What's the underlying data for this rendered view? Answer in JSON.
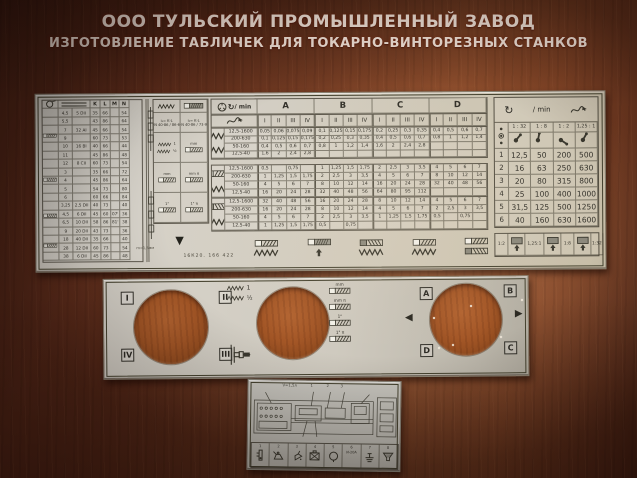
{
  "header": {
    "line1": "ООО ТУЛЬСКИЙ ПРОМЫШЛЕННЫЙ ЗАВОД",
    "line2": "ИЗГОТОВЛЕНИЕ ТАБЛИЧЕК ДЛЯ ТОКАРНО-ВИНТОРЕЗНЫХ СТАНКОВ"
  },
  "main_plate": {
    "model_text": "16К20. 166 422",
    "pitch_note": "m=1,5мм",
    "rpm_label": "/ min",
    "left_table": {
      "col_headers": [
        "K",
        "L",
        "M",
        "N"
      ],
      "rows": [
        [
          "4,5",
          "5 DII",
          "35",
          "66",
          "",
          "54"
        ],
        [
          "5,5",
          "",
          "43",
          "86",
          "",
          "64"
        ],
        [
          "7",
          "32 AI",
          "45",
          "66",
          "",
          "54"
        ],
        [
          "9",
          "",
          "60",
          "73",
          "",
          "53"
        ],
        [
          "10",
          "16 BI",
          "40",
          "66",
          "",
          "44"
        ],
        [
          "11",
          "",
          "45",
          "86",
          "",
          "48"
        ],
        [
          "12",
          "8 CII",
          "60",
          "73",
          "",
          "54"
        ],
        [
          "3",
          "",
          "35",
          "66",
          "",
          "72"
        ],
        [
          "4",
          "",
          "45",
          "86",
          "",
          "64"
        ],
        [
          "5",
          "",
          "54",
          "73",
          "",
          "80"
        ],
        [
          "6",
          "",
          "60",
          "66",
          "",
          "84"
        ],
        [
          "3,25",
          "2,5 DII",
          "40",
          "73",
          "",
          "40"
        ],
        [
          "4,5",
          "6 DII",
          "45",
          "60",
          "07'",
          "36"
        ],
        [
          "6,5",
          "10 DII",
          "58",
          "86",
          "81'",
          "38"
        ],
        [
          "9",
          "20 DII",
          "43",
          "73",
          "",
          "36"
        ],
        [
          "18",
          "40 DII",
          "35",
          "66",
          "",
          "40"
        ],
        [
          "28",
          "12 DII",
          "60",
          "73",
          "",
          "54"
        ],
        [
          "38",
          "6 DII",
          "45",
          "86",
          "",
          "48"
        ]
      ]
    },
    "mid_block": {
      "formula1": [
        "i₁= K·L",
        "L·N 40·86 / 86·64"
      ],
      "formula2": [
        "i₂= K·L",
        "L·N 40·86 / 73·96"
      ],
      "feed_labels": [
        "1",
        "½"
      ],
      "thread_units": [
        "mm",
        "mm π",
        "1\"",
        "1\" π"
      ]
    },
    "grid": {
      "groups": [
        "A",
        "B",
        "C",
        "D"
      ],
      "subcols": [
        "I",
        "II",
        "III",
        "IV"
      ],
      "sections": [
        {
          "name": "feeds",
          "rows": [
            {
              "range": "12,5-1600",
              "values": [
                "0,05",
                "0,06",
                "0,075",
                "0,09",
                "0,1",
                "0,125",
                "0,15",
                "0,175",
                "0,2",
                "0,25",
                "0,3",
                "0,35",
                "0,4",
                "0,5",
                "0,6",
                "0,7"
              ]
            },
            {
              "range": "200-630",
              "values": [
                "0,1",
                "0,125",
                "0,15",
                "0,175",
                "0,2",
                "0,25",
                "0,3",
                "0,35",
                "0,4",
                "0,5",
                "0,6",
                "0,7",
                "0,8",
                "1",
                "1,2",
                "1,4"
              ]
            },
            {
              "range": "50-160",
              "values": [
                "0,4",
                "0,5",
                "0,6",
                "0,7",
                "0,8",
                "1",
                "1,2",
                "1,4",
                "1,6",
                "2",
                "2,4",
                "2,8",
                "",
                "",
                "",
                ""
              ]
            },
            {
              "range": "12,5-40",
              "values": [
                "1,6",
                "2",
                "2,4",
                "2,8",
                "",
                "",
                "",
                "",
                "",
                "",
                "",
                "",
                "",
                "",
                "",
                ""
              ]
            }
          ]
        },
        {
          "name": "threads-direct",
          "rows": [
            {
              "range": "12,5-1600",
              "values": [
                "0,5",
                "",
                "0,75",
                "",
                "1",
                "1,25",
                "1,5",
                "1,75",
                "2",
                "2,5",
                "3",
                "3,5",
                "4",
                "5",
                "6",
                "7"
              ]
            },
            {
              "range": "200-630",
              "values": [
                "1",
                "1,25",
                "1,5",
                "1,75",
                "2",
                "2,5",
                "3",
                "3,5",
                "4",
                "5",
                "6",
                "7",
                "8",
                "10",
                "12",
                "14"
              ]
            },
            {
              "range": "50-160",
              "values": [
                "4",
                "5",
                "6",
                "7",
                "8",
                "10",
                "12",
                "14",
                "16",
                "20",
                "24",
                "28",
                "32",
                "40",
                "48",
                "56"
              ]
            },
            {
              "range": "12,5-40",
              "values": [
                "16",
                "20",
                "24",
                "28",
                "32",
                "40",
                "48",
                "56",
                "64",
                "80",
                "95",
                "112",
                "",
                "",
                "",
                ""
              ]
            }
          ]
        },
        {
          "name": "threads-inverse",
          "rows": [
            {
              "range": "12,5-1600",
              "values": [
                "32",
                "40",
                "48",
                "56",
                "16",
                "20",
                "24",
                "28",
                "8",
                "10",
                "12",
                "14",
                "4",
                "5",
                "6",
                "7"
              ]
            },
            {
              "range": "200-630",
              "values": [
                "16",
                "20",
                "24",
                "28",
                "8",
                "10",
                "12",
                "14",
                "4",
                "5",
                "6",
                "7",
                "2",
                "2,5",
                "3",
                "3,5"
              ]
            },
            {
              "range": "50-160",
              "values": [
                "4",
                "5",
                "6",
                "7",
                "2",
                "2,5",
                "3",
                "3,5",
                "1",
                "1,25",
                "1,5",
                "1,75",
                "0,5",
                "",
                "0,75",
                ""
              ]
            },
            {
              "range": "12,5-40",
              "values": [
                "1",
                "1,25",
                "1,5",
                "1,75",
                "0,5",
                "",
                "0,75",
                "",
                "",
                "",
                "",
                "",
                "",
                "",
                "",
                ""
              ]
            }
          ]
        }
      ]
    },
    "speed_table": {
      "ratios": [
        "1 : 32",
        "1 : 8",
        "1 : 2",
        "1,25 : 1"
      ],
      "rows": [
        {
          "pos": "1",
          "values": [
            "12,5",
            "50",
            "200",
            "500"
          ]
        },
        {
          "pos": "2",
          "values": [
            "16",
            "63",
            "250",
            "630"
          ]
        },
        {
          "pos": "3",
          "values": [
            "20",
            "80",
            "315",
            "800"
          ]
        },
        {
          "pos": "4",
          "values": [
            "25",
            "100",
            "400",
            "1000"
          ]
        },
        {
          "pos": "5",
          "values": [
            "31,5",
            "125",
            "500",
            "1250"
          ]
        },
        {
          "pos": "6",
          "values": [
            "40",
            "160",
            "630",
            "1600"
          ]
        }
      ],
      "legend": [
        "1:2",
        "1,25:1",
        "1:8",
        "1:32"
      ]
    }
  },
  "middle_plate": {
    "hole1_corners": [
      "I",
      "II",
      "IV",
      "III"
    ],
    "hole3_corners": [
      "A",
      "B",
      "D",
      "C"
    ],
    "feed_labels": [
      "1",
      "½"
    ],
    "thread_units": [
      "mm",
      "mm π",
      "1\"",
      "1\" π"
    ]
  },
  "bottom_plate": {
    "volume_note": "V=1,5л",
    "callouts": [
      "1",
      "2",
      "3"
    ],
    "cells": [
      {
        "n": "1",
        "icon": "level",
        "text": ""
      },
      {
        "n": "2",
        "icon": "oilcan",
        "text": ""
      },
      {
        "n": "3",
        "icon": "oilcan-tilt",
        "text": ""
      },
      {
        "n": "4",
        "icon": "grease",
        "text": ""
      },
      {
        "n": "5",
        "icon": "ring",
        "text": ""
      },
      {
        "n": "6",
        "icon": "text",
        "text": "И-20А"
      },
      {
        "n": "7",
        "icon": "fitting",
        "text": ""
      },
      {
        "n": "8",
        "icon": "strainer",
        "text": ""
      }
    ]
  },
  "colors": {
    "wood_dark": "#502517",
    "wood_light": "#95522f",
    "plate": "#d3cec3",
    "ink": "#3a382e",
    "title_text": "#f2e3d8"
  }
}
